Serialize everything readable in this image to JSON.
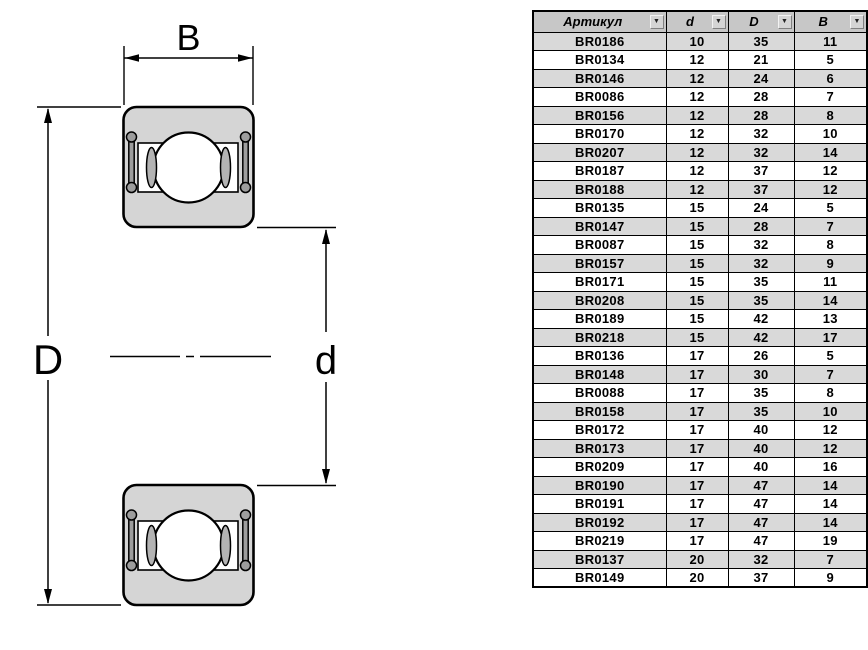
{
  "theme": {
    "body_fill": "#d5d5d5",
    "seal_fill": "#9d9d9d",
    "crescent_fill": "#b3b3b3",
    "line_color": "#000000",
    "header_bg": "#c7c7c7",
    "stripe_bg": "#d9d9d9",
    "border_color": "#000000"
  },
  "diagram": {
    "type": "bearing-cross-section",
    "labels": {
      "width": "B",
      "outer_diameter": "D",
      "bore_diameter": "d"
    }
  },
  "table": {
    "filter_icon": "▼",
    "columns": [
      {
        "key": "article",
        "label": "Артикул"
      },
      {
        "key": "d",
        "label": "d"
      },
      {
        "key": "D",
        "label": "D"
      },
      {
        "key": "B",
        "label": "B"
      }
    ],
    "rows": [
      {
        "article": "BR0186",
        "d": "10",
        "D": "35",
        "B": "11"
      },
      {
        "article": "BR0134",
        "d": "12",
        "D": "21",
        "B": "5"
      },
      {
        "article": "BR0146",
        "d": "12",
        "D": "24",
        "B": "6"
      },
      {
        "article": "BR0086",
        "d": "12",
        "D": "28",
        "B": "7"
      },
      {
        "article": "BR0156",
        "d": "12",
        "D": "28",
        "B": "8"
      },
      {
        "article": "BR0170",
        "d": "12",
        "D": "32",
        "B": "10"
      },
      {
        "article": "BR0207",
        "d": "12",
        "D": "32",
        "B": "14"
      },
      {
        "article": "BR0187",
        "d": "12",
        "D": "37",
        "B": "12"
      },
      {
        "article": "BR0188",
        "d": "12",
        "D": "37",
        "B": "12"
      },
      {
        "article": "BR0135",
        "d": "15",
        "D": "24",
        "B": "5"
      },
      {
        "article": "BR0147",
        "d": "15",
        "D": "28",
        "B": "7"
      },
      {
        "article": "BR0087",
        "d": "15",
        "D": "32",
        "B": "8"
      },
      {
        "article": "BR0157",
        "d": "15",
        "D": "32",
        "B": "9"
      },
      {
        "article": "BR0171",
        "d": "15",
        "D": "35",
        "B": "11"
      },
      {
        "article": "BR0208",
        "d": "15",
        "D": "35",
        "B": "14"
      },
      {
        "article": "BR0189",
        "d": "15",
        "D": "42",
        "B": "13"
      },
      {
        "article": "BR0218",
        "d": "15",
        "D": "42",
        "B": "17"
      },
      {
        "article": "BR0136",
        "d": "17",
        "D": "26",
        "B": "5"
      },
      {
        "article": "BR0148",
        "d": "17",
        "D": "30",
        "B": "7"
      },
      {
        "article": "BR0088",
        "d": "17",
        "D": "35",
        "B": "8"
      },
      {
        "article": "BR0158",
        "d": "17",
        "D": "35",
        "B": "10"
      },
      {
        "article": "BR0172",
        "d": "17",
        "D": "40",
        "B": "12"
      },
      {
        "article": "BR0173",
        "d": "17",
        "D": "40",
        "B": "12"
      },
      {
        "article": "BR0209",
        "d": "17",
        "D": "40",
        "B": "16"
      },
      {
        "article": "BR0190",
        "d": "17",
        "D": "47",
        "B": "14"
      },
      {
        "article": "BR0191",
        "d": "17",
        "D": "47",
        "B": "14"
      },
      {
        "article": "BR0192",
        "d": "17",
        "D": "47",
        "B": "14"
      },
      {
        "article": "BR0219",
        "d": "17",
        "D": "47",
        "B": "19"
      },
      {
        "article": "BR0137",
        "d": "20",
        "D": "32",
        "B": "7"
      },
      {
        "article": "BR0149",
        "d": "20",
        "D": "37",
        "B": "9"
      }
    ]
  }
}
